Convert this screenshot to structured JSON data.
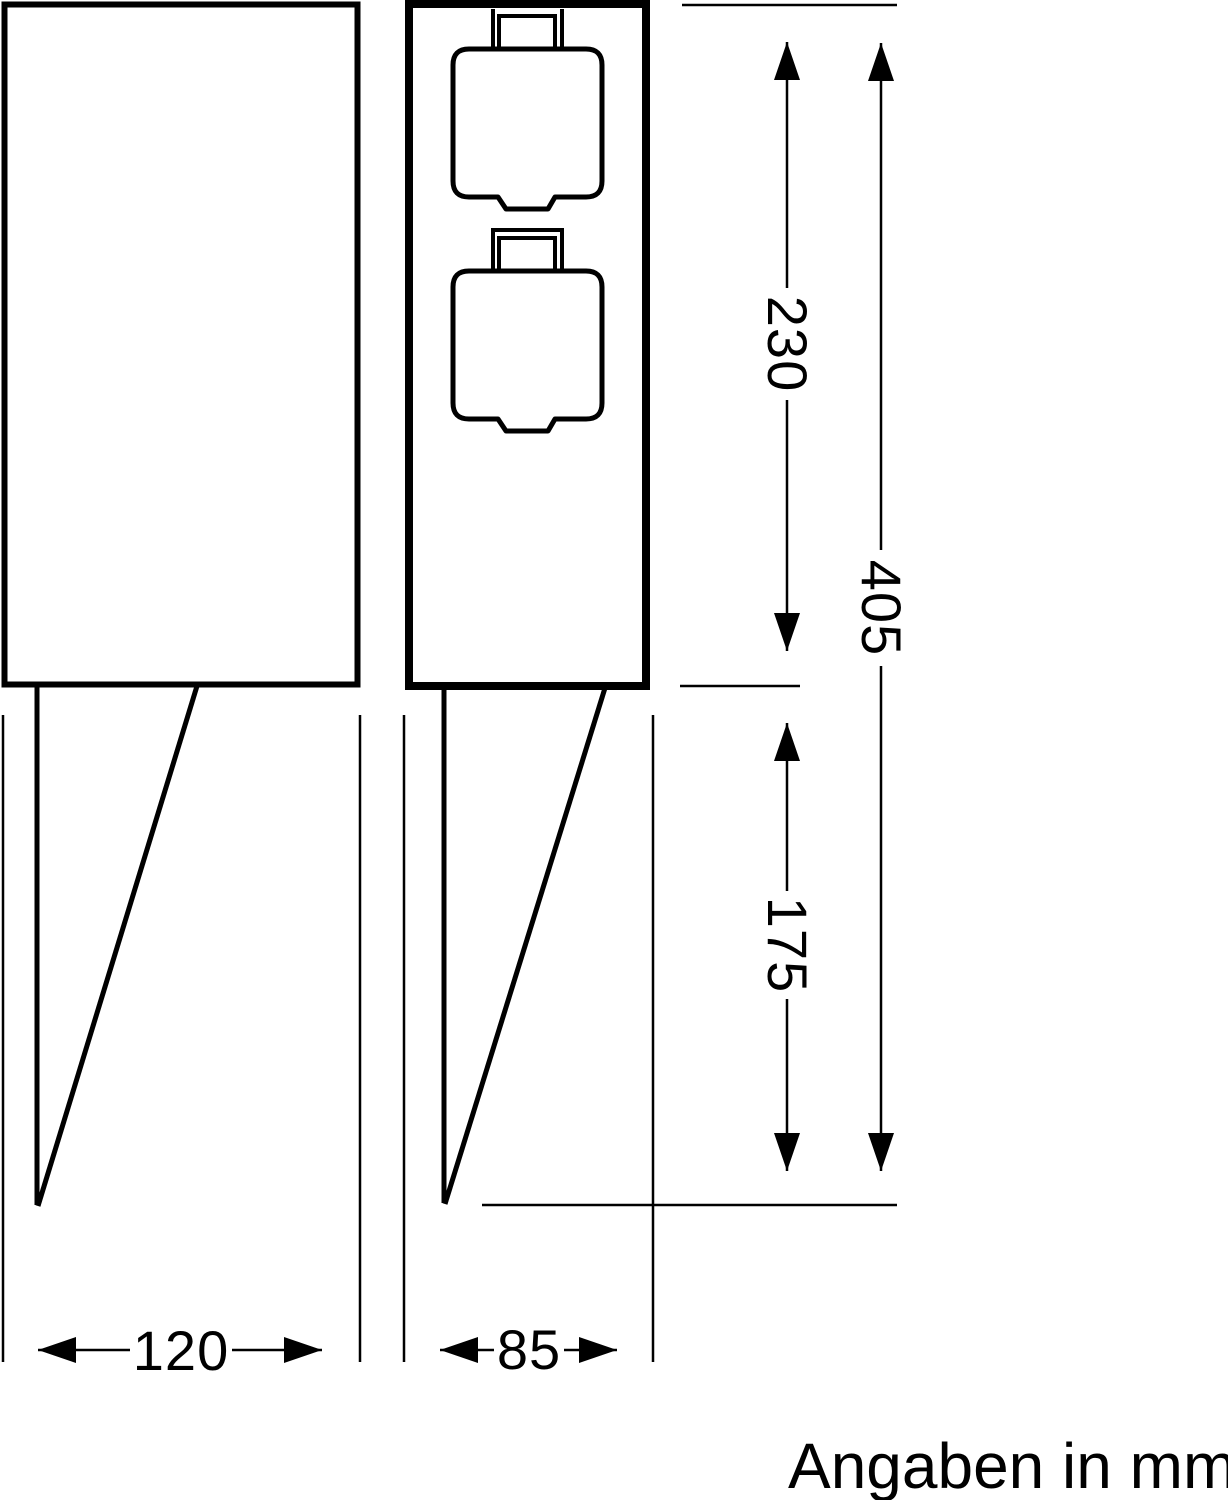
{
  "drawing": {
    "units_note": "Angaben in mm",
    "dimensions": {
      "housing_height": "230",
      "total_height": "405",
      "spike_length": "175",
      "front_width": "120",
      "side_width": "85"
    },
    "colors": {
      "ink": "#000000",
      "background": "#ffffff"
    }
  }
}
